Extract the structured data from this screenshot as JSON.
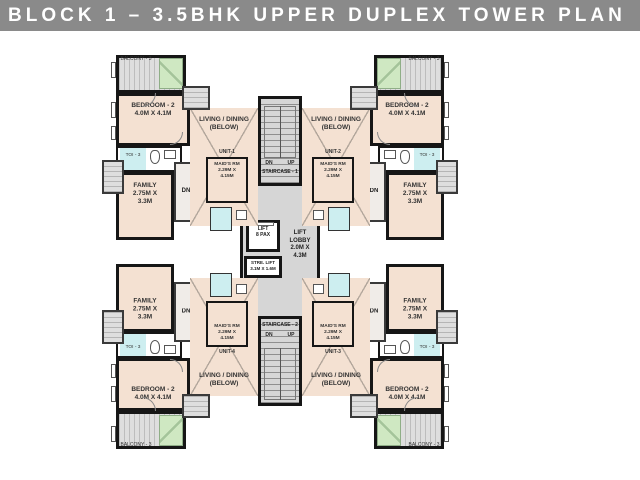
{
  "title": "BLOCK 1 – 3.5BHK UPPER DUPLEX TOWER PLAN",
  "colors": {
    "title_bar": "#8A8A8A",
    "title_text": "#FFFFFF",
    "room_fill": "#F4E1D2",
    "core_fill": "#D6D6D6",
    "planter_green": "#CFE8C2",
    "toilet_cyan": "#CDEEF0",
    "wall": "#161616"
  },
  "core": {
    "staircase_top": {
      "label": "STAIRCASE - 1",
      "dn": "DN",
      "up": "UP"
    },
    "staircase_bottom": {
      "label": "STAIRCASE - 2",
      "dn": "DN",
      "up": "UP"
    },
    "lift": {
      "line1": "LIFT",
      "line2": "8 PAX"
    },
    "stretcher_lift": {
      "line1": "STRE. LIFT",
      "line2": "3.1M X 1.6M"
    },
    "lift_lobby": {
      "line1": "LIFT",
      "line2": "LOBBY",
      "line3": "2.0M X",
      "line4": "4.3M"
    }
  },
  "rooms": {
    "balcony": "BALCONY - 3",
    "bedroom_name": "BEDROOM - 2",
    "bedroom_dims": "4.0M X 4.1M",
    "living_line1": "LIVING / DINING",
    "living_line2": "(BELOW)",
    "family_name": "FAMILY",
    "family_dims1": "2.75M X",
    "family_dims2": "3.3M",
    "maid_name": "MAID'S RM",
    "maid_dims1": "2.29M X",
    "maid_dims2": "4.15M",
    "toilet": "TOI - 3",
    "stair_dn": "DN"
  },
  "units": [
    {
      "label": "UNIT-1",
      "position": "top-left"
    },
    {
      "label": "UNIT-2",
      "position": "top-right"
    },
    {
      "label": "UNIT-3",
      "position": "bottom-right"
    },
    {
      "label": "UNIT-4",
      "position": "bottom-left"
    }
  ]
}
